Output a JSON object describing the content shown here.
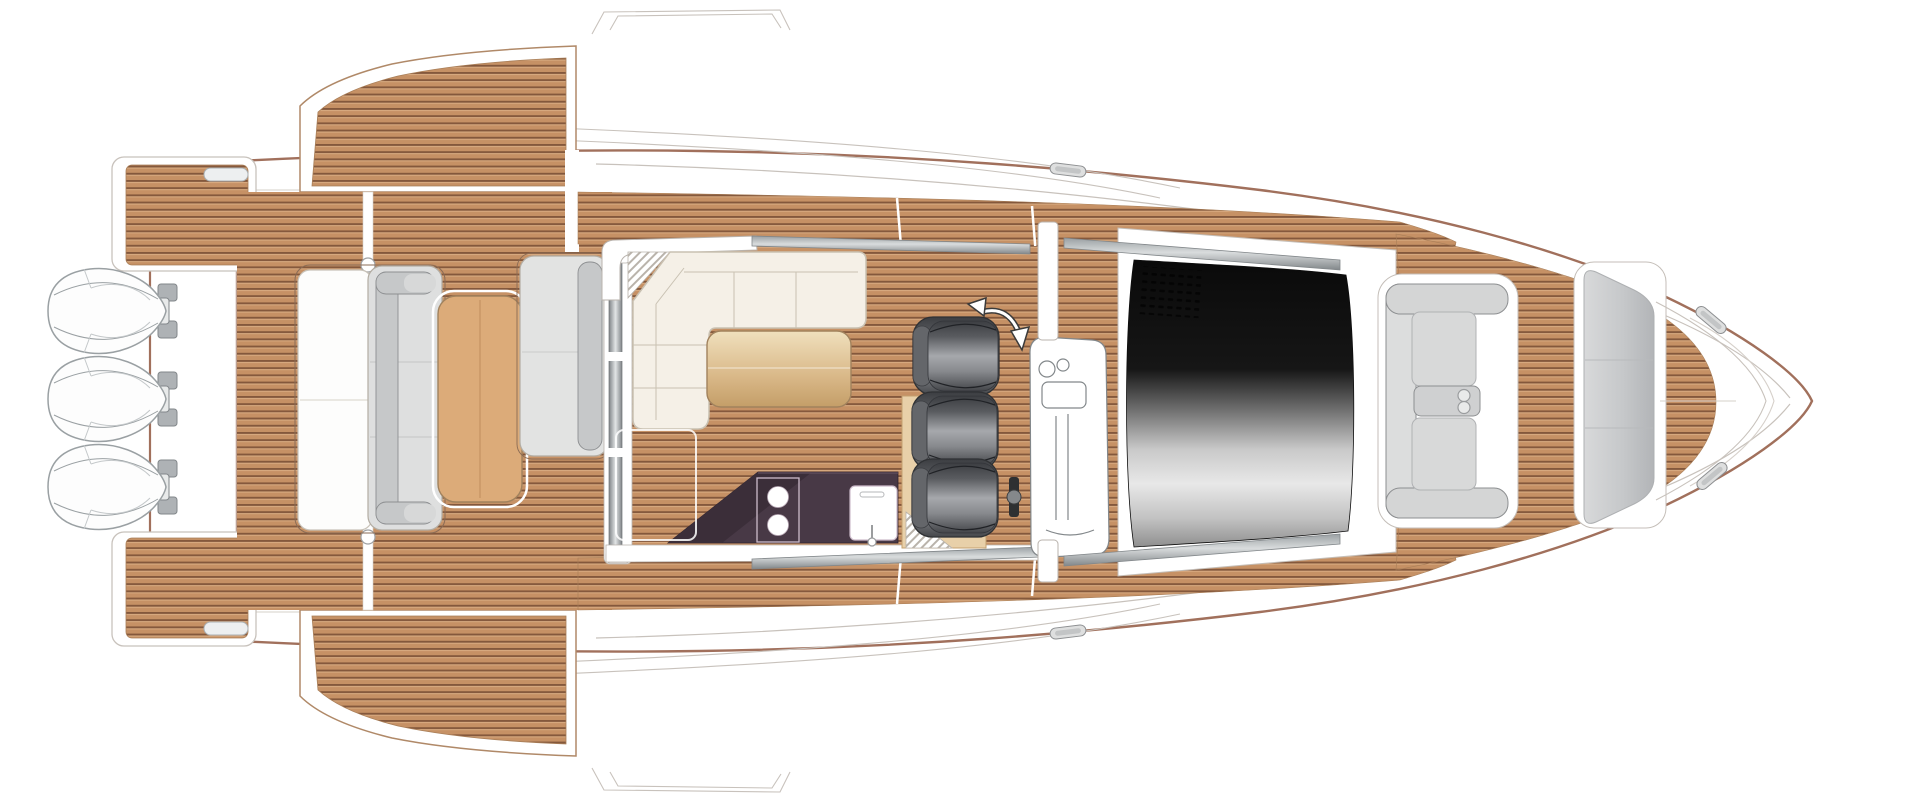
{
  "scene": {
    "label": "Yacht deck floor plan, top view, bow facing right",
    "type": "deck-plan-illustration",
    "orientation": "bow-right",
    "counts": {
      "outboard_engines": 3,
      "helm_seats": 3,
      "stove_burners": 2,
      "cup_holders": 2,
      "fold_out_terraces": 2,
      "swim_platform_wings": 2,
      "bow_cleats": 2,
      "midship_cleats": 2
    },
    "features": [
      "swim-platform",
      "outboard-engines",
      "aft-bench-sunpad",
      "cockpit-table",
      "cockpit-bench",
      "fold-out-terraces",
      "sliding-door",
      "salon-l-sofa",
      "salon-table",
      "galley-counter",
      "two-burner-stove",
      "sink",
      "companionway-steps",
      "helm-seat-platform",
      "rotatable-helm-seat",
      "helm-console",
      "windshield",
      "bow-u-seating",
      "armrest-cup-holders",
      "bow-sunpad",
      "anchor-locker",
      "cleats"
    ]
  },
  "colors": {
    "page_bg": "#ffffff",
    "white": "#ffffff",
    "hull_outline": "#a1705c",
    "hull_inner_line": "#c8c2bc",
    "detail_line": "#d6d0ca",
    "trim_stroke": "#b9b3ad",
    "wing_stroke": "#b08968",
    "teak_base": "#c69165",
    "teak_dark": "#84583c",
    "teak_light": "#d8ab80",
    "teak_edge": "#a87e58",
    "silver_dark": "#82878a",
    "silver_mid": "#aeb2b5",
    "rail_light": "#d9dcdd",
    "rail_dark": "#9aa0a3",
    "door_bar_edge": "#7f8487",
    "door_bar_center": "#e2e5e6",
    "seat_light": "#dedfdf",
    "seat_mid": "#c6c8c9",
    "seat_stroke": "#8d8f91",
    "bench_outline": "#8a6b55",
    "sunpad_white": "#fdfdfc",
    "sofa_cream": "#f5f0e7",
    "sofa_stroke": "#c9c1b2",
    "table_tan": "#dcab79",
    "table_stroke": "#a1825d",
    "gold_light": "#f0e0bd",
    "gold_mid": "#d9b888",
    "gold_dark": "#c49e68",
    "counter_purple": "#483946",
    "counter_purple_dark": "#3b2e39",
    "counter_stroke": "#2f2430",
    "galley_trim": "#cdbccb",
    "platform_tan": "#e8d0a9",
    "platform_stroke": "#c3a06f",
    "helm_stroke": "#2f3134",
    "helm_s0": "#3c3e42",
    "helm_s1": "#595b5f",
    "helm_s2": "#a6a8ac",
    "helm_s3": "#87898d",
    "helm_s4": "#44464a",
    "backrest_gray": "#64666a",
    "glass_s0": "#0a0a0a",
    "glass_s1": "#161616",
    "glass_s2": "#6e6e6e",
    "glass_s3": "#c9c9c9",
    "glass_s4": "#e8e8e8",
    "glass_s5": "#c2c2c2",
    "glass_s6": "#8f8f8f",
    "arrow_dark": "#3a3a3a",
    "bracket_black": "#2e3032",
    "knob_gray": "#85888b",
    "hatch_line": "#b9b3ab",
    "bow_seat_fill": "#d4d5d5",
    "bow_back_fill": "#dcdddd",
    "bow_cushion": "#d8d9d9",
    "armrest_fill": "#cfd0d1",
    "cup_fill": "#e9eaea",
    "sun_s0": "#d8d9da",
    "sun_s1": "#c6c8ca",
    "sun_s2": "#b2b4b7",
    "surround_stroke": "#c4beb8",
    "engine_stroke": "#9aa0a3"
  }
}
